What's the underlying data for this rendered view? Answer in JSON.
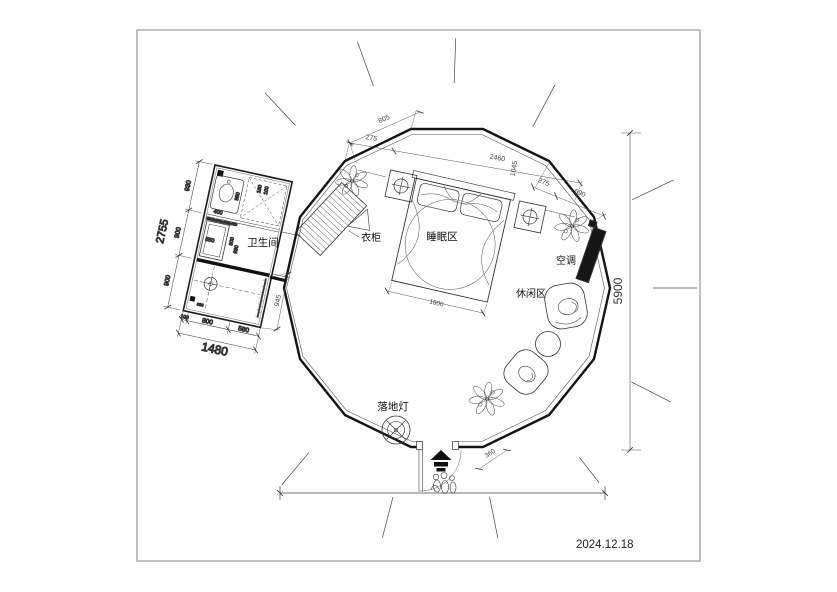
{
  "date_stamp": "2024.12.18",
  "rooms": {
    "bathroom": "卫生间",
    "wardrobe": "衣柜",
    "sleeping": "睡眠区",
    "leisure": "休闲区",
    "ac": "空调",
    "floor_lamp": "落地灯"
  },
  "dims": {
    "top_edge": "805",
    "top_seg": "275",
    "top_total": "2460",
    "top_vert": "1045",
    "right_seg": "275",
    "right_end": "690",
    "overall_height": "5900",
    "bed_width": "1800",
    "entrance": "360",
    "bath_total_h": "2755",
    "bath_h1": "930",
    "bath_h2": "900",
    "bath_h3": "900",
    "bath_total_w": "1480",
    "bath_w1": "100",
    "bath_w2": "800",
    "bath_w3": "580",
    "bath_side": "945",
    "bath_in_400": "400",
    "bath_in_350": "350",
    "bath_in_160": "160",
    "bath_in_100": "100",
    "bath_in_550": "550",
    "bath_in_900": "900",
    "bath_in_930": "930",
    "bath_in_960": "960",
    "bath_note": "3500x500x500x500"
  }
}
